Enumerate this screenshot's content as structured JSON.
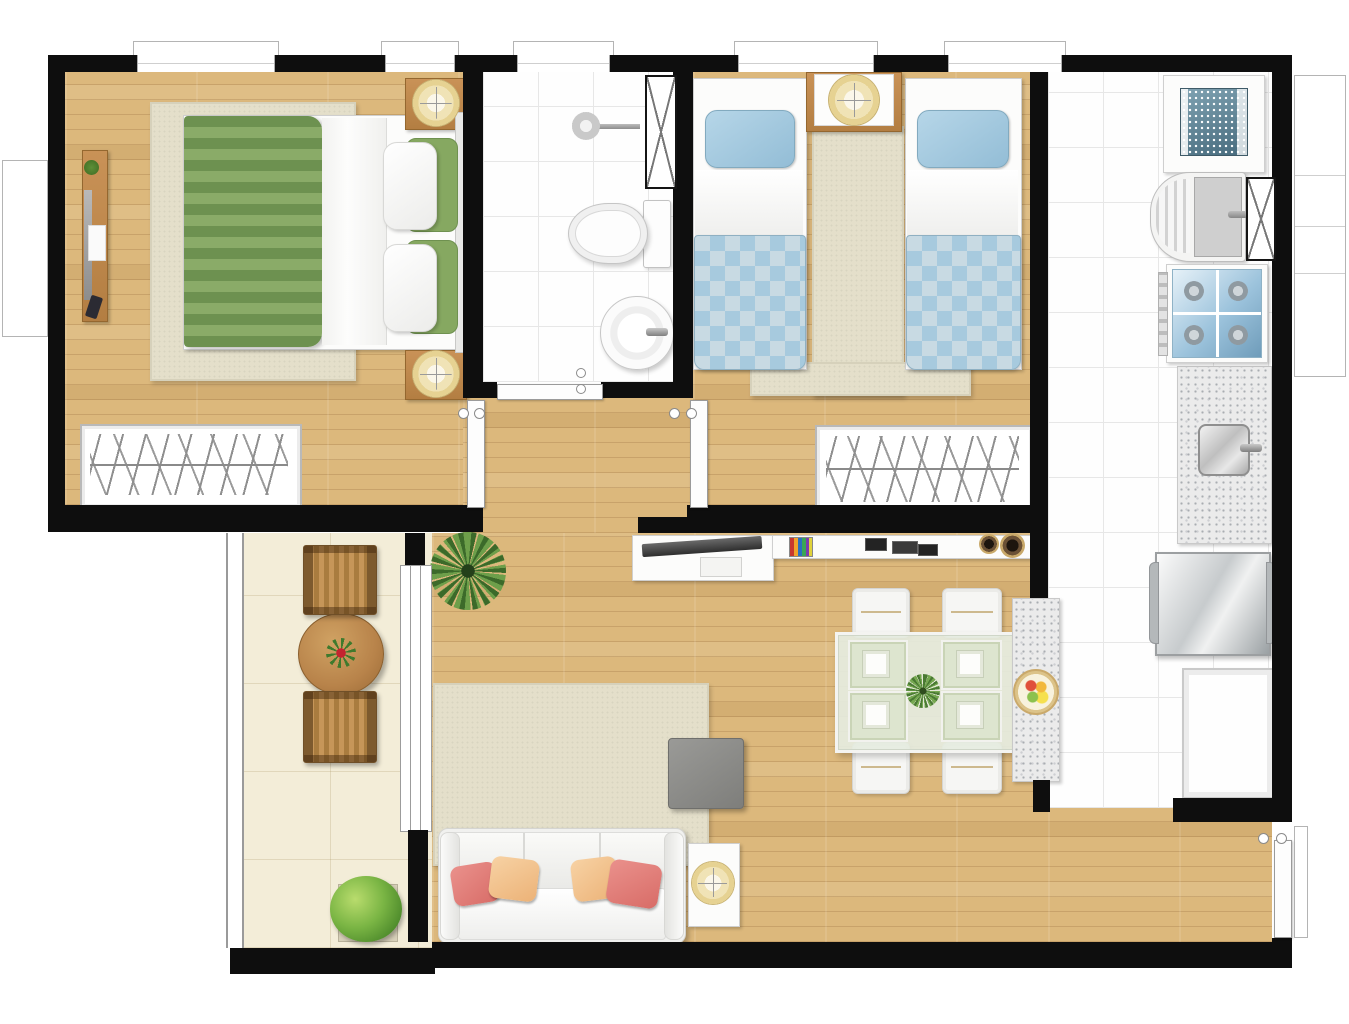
{
  "meta": {
    "type": "apartment-floor-plan",
    "style": "photoreal top-down render, no text labels",
    "canvas": {
      "width_px": 1349,
      "height_px": 1024
    }
  },
  "palette": {
    "background": "#ffffff",
    "walls": "#0e0e0e",
    "wood_floor": "#dcb87c",
    "bathroom_kitchen_tile": "#fefefe",
    "balcony_tile": "#f3edd8",
    "rug_beige": "#e4dfca",
    "green_blanket_dark": "#6d9150",
    "green_blanket_light": "#8aab68",
    "blue_bedding": "#a7cade",
    "blue_pillow": "#a9cfe3",
    "coral_pillow": "#e2827e",
    "peach_pillow": "#f2c493",
    "furniture_wood": "#c08b4f",
    "granite_counter": "#ebebeb",
    "stove_top_blue": "#bcd6e6",
    "sofa_white": "#f1f1ef",
    "pouf_gray": "#8f8f8c",
    "plant_green": "#6fa34c",
    "lamp_cream": "#f0e3b6"
  },
  "rooms": [
    {
      "id": "master-bedroom",
      "position": "top-left",
      "furniture": [
        "double-bed",
        "green-striped-blanket",
        "white-duvet",
        "two-pillow-sets",
        "area-rug",
        "nightstand-top",
        "nightstand-bottom",
        "round-lamp-top",
        "round-lamp-bottom",
        "dresser-with-tv-and-remote",
        "wardrobe-hanging-rail",
        "window"
      ]
    },
    {
      "id": "bathroom",
      "position": "top-center",
      "furniture": [
        "shower-head",
        "toilet",
        "round-washbasin",
        "ventilation-shaft",
        "door",
        "window"
      ]
    },
    {
      "id": "second-bedroom",
      "position": "top-right-of-center",
      "furniture": [
        "twin-bed-left",
        "twin-bed-right",
        "blue-pillows",
        "blue-checkered-blankets",
        "shared-nightstand",
        "round-lamp",
        "runner-rug",
        "wardrobe-hanging-rail",
        "window"
      ]
    },
    {
      "id": "kitchen-laundry",
      "position": "right-strip",
      "furniture": [
        "washing-machine-with-basket",
        "laundry-tank-sink",
        "ventilation-shaft",
        "four-burner-stove",
        "granite-counter-with-sink",
        "refrigerator",
        "white-base-cabinet",
        "window"
      ]
    },
    {
      "id": "living-dining",
      "position": "center-bottom",
      "furniture": [
        "tv-cabinet",
        "flat-tv",
        "media-shelf",
        "books",
        "picture-frames",
        "two-speakers",
        "glass-dining-table",
        "four-white-chairs",
        "four-place-settings",
        "table-centerpiece-plant",
        "granite-peninsula",
        "fruit-bowl",
        "area-rug",
        "gray-pouf",
        "three-seat-sofa",
        "four-throw-pillows",
        "side-table",
        "round-lamp",
        "palm-plant"
      ]
    },
    {
      "id": "balcony",
      "position": "bottom-left",
      "furniture": [
        "wood-slat-chair-top",
        "round-wood-table-with-flower",
        "wood-slat-chair-bottom",
        "potted-plant",
        "glass-railing",
        "sliding-door"
      ]
    },
    {
      "id": "hallway",
      "position": "center",
      "furniture": [
        "master-bedroom-door",
        "second-bedroom-door",
        "bathroom-door",
        "hinges"
      ]
    },
    {
      "id": "entry",
      "position": "bottom-right",
      "furniture": [
        "entry-door",
        "hinges"
      ]
    }
  ]
}
